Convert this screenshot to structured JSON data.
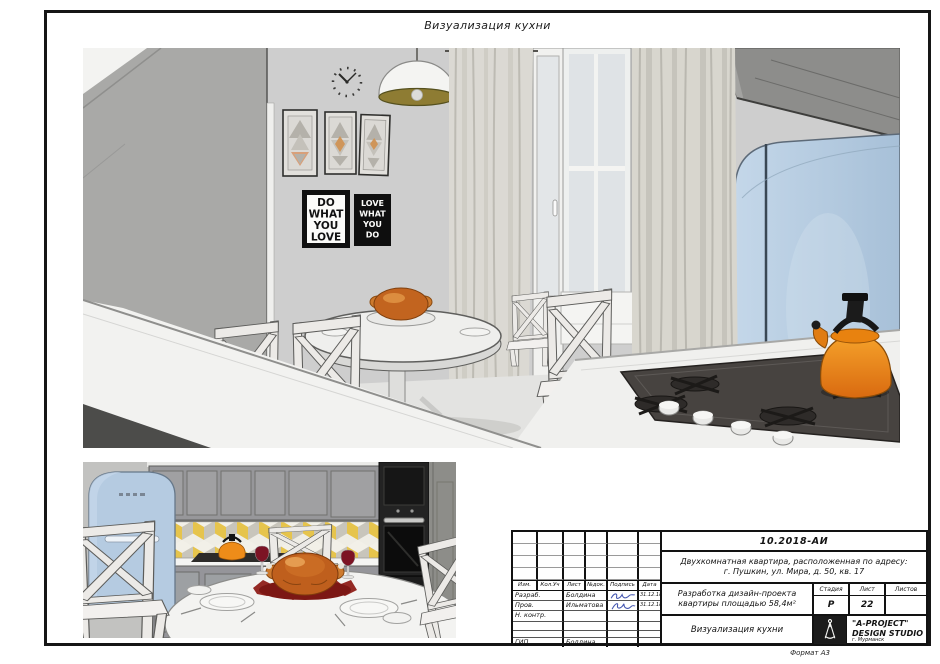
{
  "sheet": {
    "title": "Визуализация кухни",
    "format_label": "Формат А3"
  },
  "posters": {
    "left": [
      "DO",
      "WHAT",
      "YOU",
      "LOVE"
    ],
    "right": [
      "LOVE",
      "WHAT",
      "YOU",
      "DO"
    ]
  },
  "title_block": {
    "doc_number": "10.2018-АИ",
    "object_address_line1": "Двухкомнатная квартира, расположенная по адресу:",
    "object_address_line2": "г. Пушкин, ул. Мира, д. 50, кв. 17",
    "project_name_line1": "Разработка дизайн-проекта",
    "project_name_line2": "квартиры площадью 58,4м²",
    "drawing_title": "Визуализация кухни",
    "headers": {
      "izm": "Изм.",
      "kol_uch": "Кол.Уч",
      "list": "Лист",
      "n_dok": "№док.",
      "podpis": "Подпись",
      "data": "Дата"
    },
    "rows": [
      {
        "role": "Разраб.",
        "name": "Болдина",
        "date": "31.12.18"
      },
      {
        "role": "Пров.",
        "name": "Ильматова",
        "date": "31.12.18"
      },
      {
        "role": "Н. контр.",
        "name": "",
        "date": ""
      },
      {
        "role": "",
        "name": "",
        "date": ""
      },
      {
        "role": "",
        "name": "",
        "date": ""
      },
      {
        "role": "ГИП",
        "name": "Болдина",
        "date": ""
      }
    ],
    "stage_header": "Стадия",
    "stage_value": "Р",
    "list_header": "Лист",
    "list_value": "22",
    "listov_header": "Листов",
    "listov_value": "",
    "studio_name": "\"A-PROJECT\"",
    "studio_type": "DESIGN STUDIO",
    "studio_city": "г. Мурманск"
  },
  "colors": {
    "frame": "#161616",
    "fridge_blue": "#b6cce2",
    "kettle_orange": "#ee8c19",
    "tile_yellow": "#e6c44c",
    "signature_blue": "#4456b0",
    "poster_black": "#101010",
    "wall_grey": "#cecece"
  }
}
